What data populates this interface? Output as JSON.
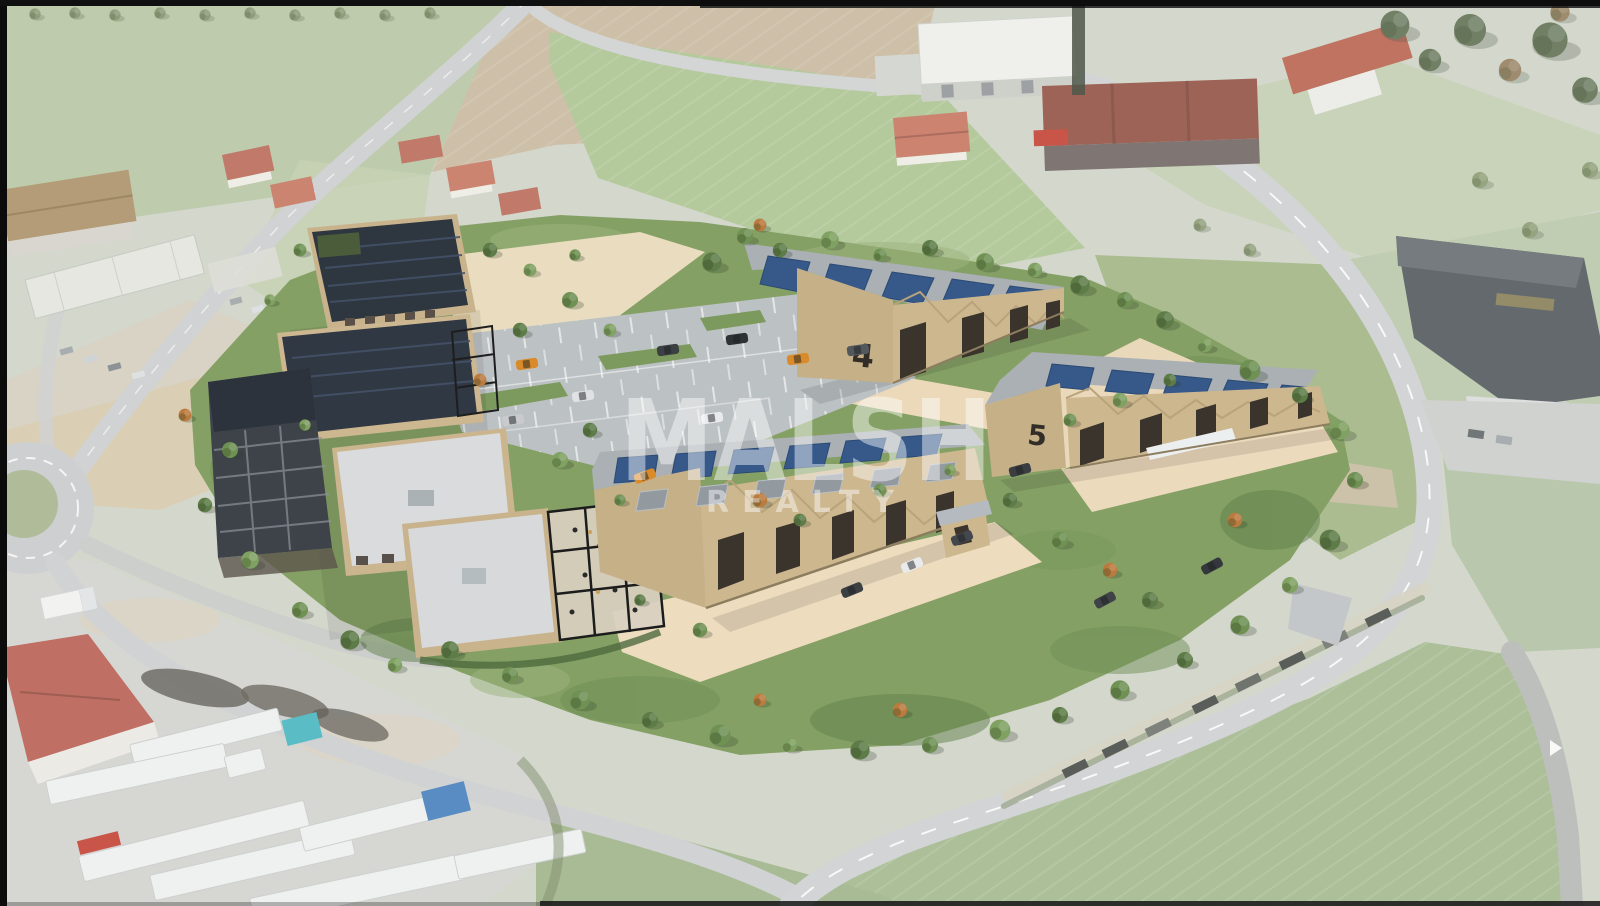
{
  "image": {
    "kind": "aerial-architectural-rendering",
    "subject": "Aerial 3D rendering of a new business park (tan warehouses and offices with photovoltaic roofs, parking, landscaping) inserted into a faded aerial photo of countryside with roads, fields, a roundabout and a truck depot",
    "watermark": {
      "line1": "MALSH",
      "line2": "REALTY",
      "color": "#ffffff"
    },
    "labels": {
      "building4": "4",
      "building5": "5"
    },
    "colors": {
      "render_wall_tan": "#cdb78f",
      "solar_panel_blue": "#37598a",
      "roof_gray": "#aab0b4",
      "vegetation_green": "#6f9154",
      "autumn_orange": "#bb7a3e",
      "road_gray": "#c9cbcc",
      "cream_plaza": "#ecd9ba",
      "watermark_white": "#ffffff",
      "edge_bar_black": "#0b0b0b",
      "truck_teal": "#3fb3bc",
      "truck_blue": "#3d7ab8",
      "red_roof": "#b5584a"
    }
  }
}
